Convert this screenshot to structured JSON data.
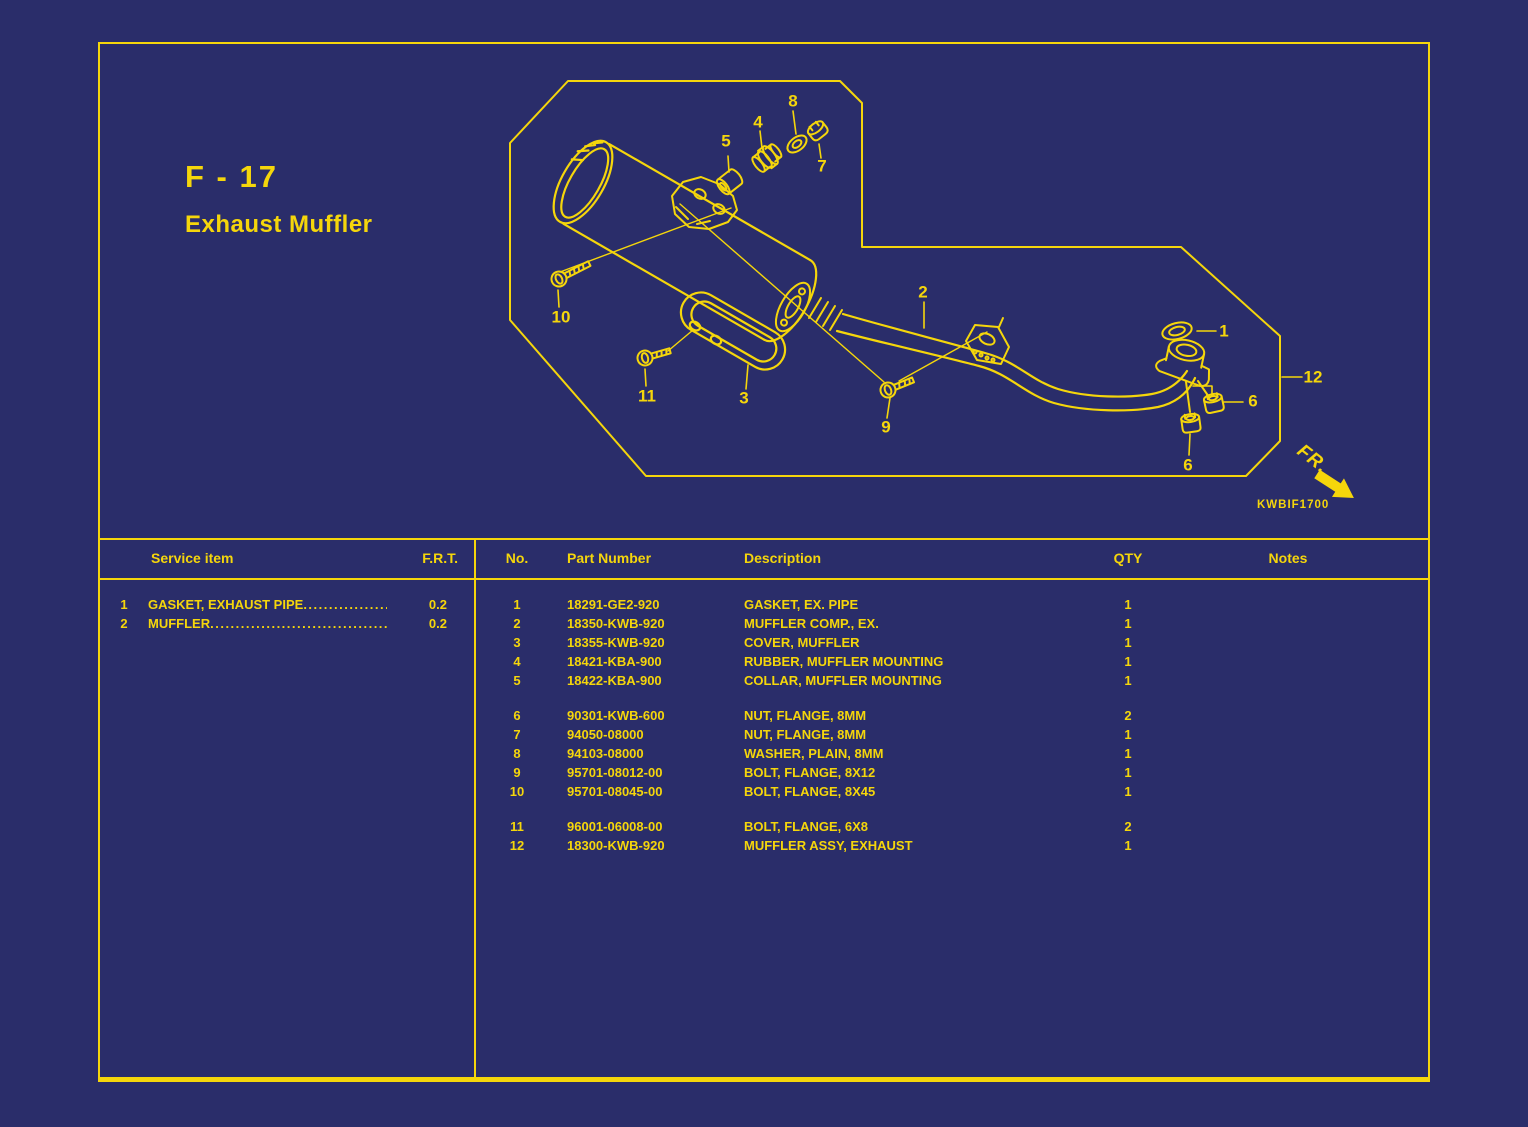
{
  "page": {
    "section_code": "F - 17",
    "section_title": "Exhaust Muffler",
    "drawing_code": "KWBIF1700",
    "front_label": "FR."
  },
  "colors": {
    "background": "#2a2d6a",
    "line": "#f5d60b"
  },
  "diagram": {
    "callouts": [
      {
        "label": "1",
        "x": 1224,
        "y": 331
      },
      {
        "label": "2",
        "x": 923,
        "y": 292
      },
      {
        "label": "3",
        "x": 744,
        "y": 398
      },
      {
        "label": "4",
        "x": 758,
        "y": 122
      },
      {
        "label": "5",
        "x": 726,
        "y": 141
      },
      {
        "label": "6",
        "x": 1253,
        "y": 401
      },
      {
        "label": "6",
        "x": 1188,
        "y": 465
      },
      {
        "label": "7",
        "x": 822,
        "y": 166
      },
      {
        "label": "8",
        "x": 793,
        "y": 101
      },
      {
        "label": "9",
        "x": 886,
        "y": 427
      },
      {
        "label": "10",
        "x": 561,
        "y": 317
      },
      {
        "label": "11",
        "x": 647,
        "y": 396
      },
      {
        "label": "12",
        "x": 1313,
        "y": 377
      }
    ]
  },
  "service_table": {
    "headers": {
      "item": "Service item",
      "frt": "F.R.T."
    },
    "rows": [
      {
        "no": "1",
        "item": "GASKET, EXHAUST PIPE",
        "frt": "0.2"
      },
      {
        "no": "2",
        "item": "MUFFLER",
        "frt": "0.2"
      }
    ]
  },
  "parts_table": {
    "headers": {
      "no": "No.",
      "part_number": "Part Number",
      "description": "Description",
      "qty": "QTY",
      "notes": "Notes"
    },
    "groups": [
      [
        {
          "no": "1",
          "part_number": "18291-GE2-920",
          "description": "GASKET, EX. PIPE",
          "qty": "1",
          "notes": ""
        },
        {
          "no": "2",
          "part_number": "18350-KWB-920",
          "description": "MUFFLER COMP., EX.",
          "qty": "1",
          "notes": ""
        },
        {
          "no": "3",
          "part_number": "18355-KWB-920",
          "description": "COVER, MUFFLER",
          "qty": "1",
          "notes": ""
        },
        {
          "no": "4",
          "part_number": "18421-KBA-900",
          "description": "RUBBER, MUFFLER MOUNTING",
          "qty": "1",
          "notes": ""
        },
        {
          "no": "5",
          "part_number": "18422-KBA-900",
          "description": "COLLAR, MUFFLER MOUNTING",
          "qty": "1",
          "notes": ""
        }
      ],
      [
        {
          "no": "6",
          "part_number": "90301-KWB-600",
          "description": "NUT, FLANGE, 8MM",
          "qty": "2",
          "notes": ""
        },
        {
          "no": "7",
          "part_number": "94050-08000",
          "description": "NUT, FLANGE, 8MM",
          "qty": "1",
          "notes": ""
        },
        {
          "no": "8",
          "part_number": "94103-08000",
          "description": "WASHER, PLAIN, 8MM",
          "qty": "1",
          "notes": ""
        },
        {
          "no": "9",
          "part_number": "95701-08012-00",
          "description": "BOLT, FLANGE, 8X12",
          "qty": "1",
          "notes": ""
        },
        {
          "no": "10",
          "part_number": "95701-08045-00",
          "description": "BOLT, FLANGE, 8X45",
          "qty": "1",
          "notes": ""
        }
      ],
      [
        {
          "no": "11",
          "part_number": "96001-06008-00",
          "description": "BOLT, FLANGE, 6X8",
          "qty": "2",
          "notes": ""
        },
        {
          "no": "12",
          "part_number": "18300-KWB-920",
          "description": "MUFFLER ASSY, EXHAUST",
          "qty": "1",
          "notes": ""
        }
      ]
    ]
  }
}
